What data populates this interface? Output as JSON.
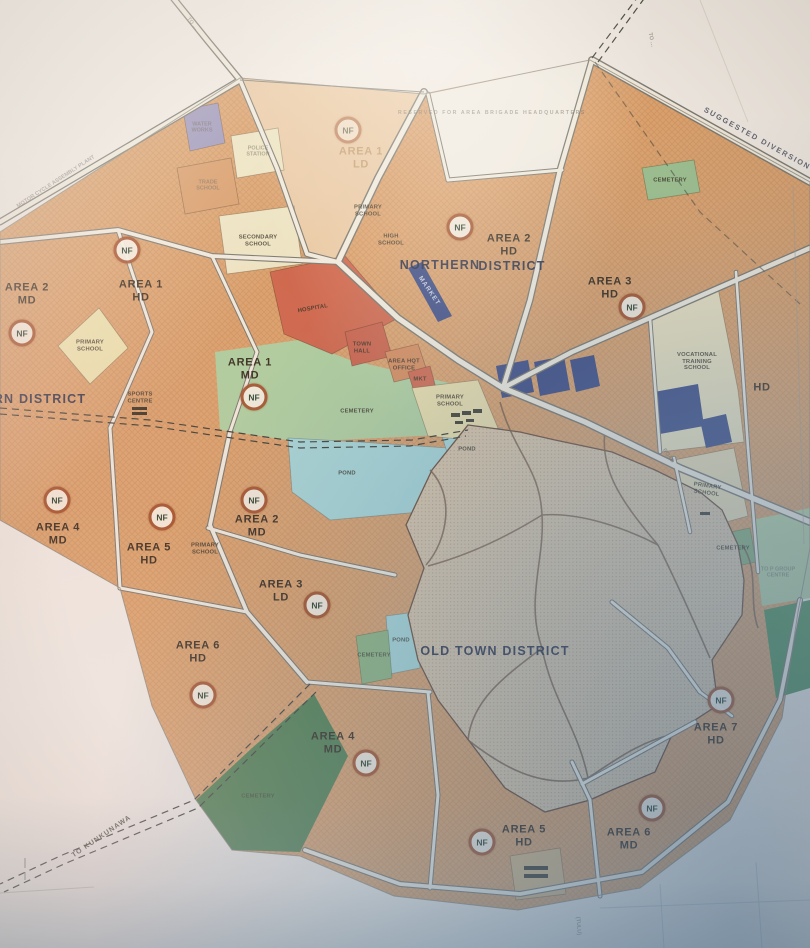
{
  "map": {
    "nf_text": "NF",
    "colors": {
      "paper": "#f0e9e0",
      "parcel_orange": "#dfa169",
      "parcel_red": "#d4674a",
      "cream": "#ede2bd",
      "green_light": "#aecf9c",
      "green_dark": "#4f7f4a",
      "pond_teal": "#a5d6d6",
      "navy": "#3c4a86",
      "purple": "#9e96bb",
      "old_town": "#d9c3a4",
      "road": "#f0e9da",
      "nf_ring": "#a34f28"
    },
    "nf_markers": [
      {
        "x": 348,
        "y": 130,
        "o": 0.55
      },
      {
        "x": 460,
        "y": 227
      },
      {
        "x": 632,
        "y": 307
      },
      {
        "x": 127,
        "y": 250
      },
      {
        "x": 22,
        "y": 333
      },
      {
        "x": 254,
        "y": 397
      },
      {
        "x": 57,
        "y": 500
      },
      {
        "x": 162,
        "y": 517
      },
      {
        "x": 254,
        "y": 500
      },
      {
        "x": 317,
        "y": 605
      },
      {
        "x": 203,
        "y": 695
      },
      {
        "x": 366,
        "y": 763
      },
      {
        "x": 482,
        "y": 842
      },
      {
        "x": 652,
        "y": 808
      },
      {
        "x": 721,
        "y": 700
      }
    ],
    "labels": [
      {
        "name": "road-label-to-nw",
        "lines": [
          "TO …"
        ],
        "x": 192,
        "y": 24,
        "cls": "tf",
        "rot": 52
      },
      {
        "name": "reserved-note",
        "lines": [
          "RESERVED FOR AREA BRIGADE HEADQUARTERS"
        ],
        "x": 492,
        "y": 114,
        "cls": "tf sp"
      },
      {
        "name": "road-label-to-ne",
        "lines": [
          "TO …"
        ],
        "x": 651,
        "y": 40,
        "cls": "tf",
        "rot": 78
      },
      {
        "name": "road-label-suggested-diversion",
        "lines": [
          "SUGGESTED DIVERSION"
        ],
        "x": 757,
        "y": 139,
        "cls": "sg",
        "rot": 29
      },
      {
        "name": "label-motor-cycle-assembly-plant",
        "lines": [
          "MOTOR CYCLE ASSEMBLY PLANT"
        ],
        "x": 56,
        "y": 182,
        "cls": "tf",
        "rot": -33
      },
      {
        "name": "parcel-label-water-works",
        "lines": [
          "WATER",
          "WORKS"
        ],
        "x": 202,
        "y": 128,
        "cls": "tf"
      },
      {
        "name": "parcel-label-police-station",
        "lines": [
          "POLICE",
          "STATION"
        ],
        "x": 258,
        "y": 152,
        "cls": "tf"
      },
      {
        "name": "parcel-label-trade-school",
        "lines": [
          "TRADE",
          "SCHOOL"
        ],
        "x": 208,
        "y": 186,
        "cls": "tf"
      },
      {
        "name": "area-label-area-1-ld",
        "lines": [
          "AREA 1",
          "LD"
        ],
        "x": 361,
        "y": 158,
        "cls": "a faded"
      },
      {
        "name": "parcel-label-secondary-school",
        "lines": [
          "SECONDARY",
          "SCHOOL"
        ],
        "x": 258,
        "y": 241,
        "cls": "t"
      },
      {
        "name": "parcel-label-primary-school-n",
        "lines": [
          "PRIMARY",
          "SCHOOL"
        ],
        "x": 368,
        "y": 211,
        "cls": "t"
      },
      {
        "name": "parcel-label-high-school",
        "lines": [
          "HIGH",
          "SCHOOL"
        ],
        "x": 391,
        "y": 240,
        "cls": "t"
      },
      {
        "name": "district-label-northern",
        "lines": [
          "NORTHERN"
        ],
        "x": 440,
        "y": 265,
        "cls": "d"
      },
      {
        "name": "district-label-northern-2",
        "lines": [
          "DISTRICT"
        ],
        "x": 512,
        "y": 266,
        "cls": "d"
      },
      {
        "name": "area-label-area-2-hd",
        "lines": [
          "AREA 2",
          "HD"
        ],
        "x": 509,
        "y": 245,
        "cls": "a"
      },
      {
        "name": "area-label-area-3-hd",
        "lines": [
          "AREA 3",
          "HD"
        ],
        "x": 610,
        "y": 288,
        "cls": "a"
      },
      {
        "name": "parcel-label-cemetery-ne",
        "lines": [
          "CEMETERY"
        ],
        "x": 670,
        "y": 181,
        "cls": "t"
      },
      {
        "name": "area-label-area-1-hd",
        "lines": [
          "AREA 1",
          "HD"
        ],
        "x": 141,
        "y": 291,
        "cls": "a"
      },
      {
        "name": "area-label-area-2-md-west",
        "lines": [
          "AREA 2",
          "MD"
        ],
        "x": 27,
        "y": 294,
        "cls": "a"
      },
      {
        "name": "district-label-western",
        "lines": [
          "RN DISTRICT"
        ],
        "x": 40,
        "y": 399,
        "cls": "d"
      },
      {
        "name": "area-label-area-1-md",
        "lines": [
          "AREA 1",
          "MD"
        ],
        "x": 250,
        "y": 369,
        "cls": "a"
      },
      {
        "name": "parcel-label-hospital",
        "lines": [
          "HOSPITAL"
        ],
        "x": 313,
        "y": 309,
        "cls": "t",
        "rot": -10
      },
      {
        "name": "parcel-label-town-hall",
        "lines": [
          "TOWN",
          "HALL"
        ],
        "x": 362,
        "y": 348,
        "cls": "t"
      },
      {
        "name": "parcel-label-area-hqt-office",
        "lines": [
          "AREA HQT",
          "OFFICE"
        ],
        "x": 404,
        "y": 365,
        "cls": "t"
      },
      {
        "name": "parcel-label-mkt",
        "lines": [
          "MKT"
        ],
        "x": 420,
        "y": 380,
        "cls": "t"
      },
      {
        "name": "parcel-label-market",
        "lines": [
          "MARKET"
        ],
        "x": 429,
        "y": 291,
        "cls": "tw",
        "rot": 56
      },
      {
        "name": "parcel-label-primary-school-west",
        "lines": [
          "PRIMARY",
          "SCHOOL"
        ],
        "x": 90,
        "y": 346,
        "cls": "t"
      },
      {
        "name": "parcel-label-sports-centre",
        "lines": [
          "SPORTS",
          "CENTRE"
        ],
        "x": 140,
        "y": 398,
        "cls": "t"
      },
      {
        "name": "parcel-label-cemetery-c",
        "lines": [
          "CEMETERY"
        ],
        "x": 357,
        "y": 412,
        "cls": "t"
      },
      {
        "name": "parcel-label-primary-school-c",
        "lines": [
          "PRIMARY",
          "SCHOOL"
        ],
        "x": 450,
        "y": 401,
        "cls": "t"
      },
      {
        "name": "parcel-label-pond-w",
        "lines": [
          "POND"
        ],
        "x": 347,
        "y": 474,
        "cls": "t"
      },
      {
        "name": "parcel-label-pond-c",
        "lines": [
          "POND"
        ],
        "x": 467,
        "y": 450,
        "cls": "t"
      },
      {
        "name": "parcel-label-vocational",
        "lines": [
          "VOCATIONAL",
          "TRAINING",
          "SCHOOL"
        ],
        "x": 697,
        "y": 362,
        "cls": "t"
      },
      {
        "name": "area-label-hd-east",
        "lines": [
          "HD"
        ],
        "x": 762,
        "y": 388,
        "cls": "a"
      },
      {
        "name": "parcel-label-primary-school-e",
        "lines": [
          "PRIMARY",
          "SCHOOL"
        ],
        "x": 707,
        "y": 490,
        "cls": "t",
        "rot": 8
      },
      {
        "name": "parcel-label-cemetery-e",
        "lines": [
          "CEMETERY"
        ],
        "x": 733,
        "y": 549,
        "cls": "t"
      },
      {
        "name": "parcel-label-p-group-centre",
        "lines": [
          "TO P GROUP",
          "CENTRE"
        ],
        "x": 778,
        "y": 573,
        "cls": "tf"
      },
      {
        "name": "road-label-road-e",
        "lines": [
          "ROAD"
        ],
        "x": 668,
        "y": 456,
        "cls": "tf",
        "rot": 55
      },
      {
        "name": "parcel-label-primary-school-sw",
        "lines": [
          "PRIMARY",
          "SCHOOL"
        ],
        "x": 205,
        "y": 549,
        "cls": "t"
      },
      {
        "name": "area-label-area-4-md-west",
        "lines": [
          "AREA 4",
          "MD"
        ],
        "x": 58,
        "y": 534,
        "cls": "a"
      },
      {
        "name": "area-label-area-5-hd-west",
        "lines": [
          "AREA 5",
          "HD"
        ],
        "x": 149,
        "y": 554,
        "cls": "a"
      },
      {
        "name": "area-label-area-2-md-c",
        "lines": [
          "AREA 2",
          "MD"
        ],
        "x": 257,
        "y": 526,
        "cls": "a"
      },
      {
        "name": "area-label-area-3-ld",
        "lines": [
          "AREA 3",
          "LD"
        ],
        "x": 281,
        "y": 591,
        "cls": "a"
      },
      {
        "name": "district-label-old-town",
        "lines": [
          "OLD TOWN DISTRICT"
        ],
        "x": 495,
        "y": 651,
        "cls": "d"
      },
      {
        "name": "parcel-label-cemetery-os",
        "lines": [
          "CEMETERY"
        ],
        "x": 374,
        "y": 656,
        "cls": "t",
        "o": 0.7
      },
      {
        "name": "parcel-label-pond-os",
        "lines": [
          "POND"
        ],
        "x": 401,
        "y": 641,
        "cls": "t",
        "o": 0.8
      },
      {
        "name": "area-label-area-6-hd",
        "lines": [
          "AREA 6",
          "HD"
        ],
        "x": 198,
        "y": 652,
        "cls": "a"
      },
      {
        "name": "parcel-label-cemetery-sw",
        "lines": [
          "CEMETERY"
        ],
        "x": 258,
        "y": 797,
        "cls": "t",
        "o": 0.55
      },
      {
        "name": "road-label-to-kunkunawa",
        "lines": [
          "TO KUNKUNAWA"
        ],
        "x": 102,
        "y": 837,
        "cls": "k",
        "rot": -34
      },
      {
        "name": "area-label-area-4-md-s",
        "lines": [
          "AREA 4",
          "MD"
        ],
        "x": 333,
        "y": 743,
        "cls": "a"
      },
      {
        "name": "area-label-area-5-hd-s",
        "lines": [
          "AREA 5",
          "HD"
        ],
        "x": 524,
        "y": 836,
        "cls": "a"
      },
      {
        "name": "area-label-area-6-md",
        "lines": [
          "AREA 6",
          "MD"
        ],
        "x": 629,
        "y": 839,
        "cls": "a"
      },
      {
        "name": "area-label-area-7-hd",
        "lines": [
          "AREA 7",
          "HD"
        ],
        "x": 716,
        "y": 734,
        "cls": "a"
      },
      {
        "name": "road-label-tulu",
        "lines": [
          "(TULU)"
        ],
        "x": 578,
        "y": 926,
        "cls": "tf",
        "rot": 86
      }
    ]
  }
}
